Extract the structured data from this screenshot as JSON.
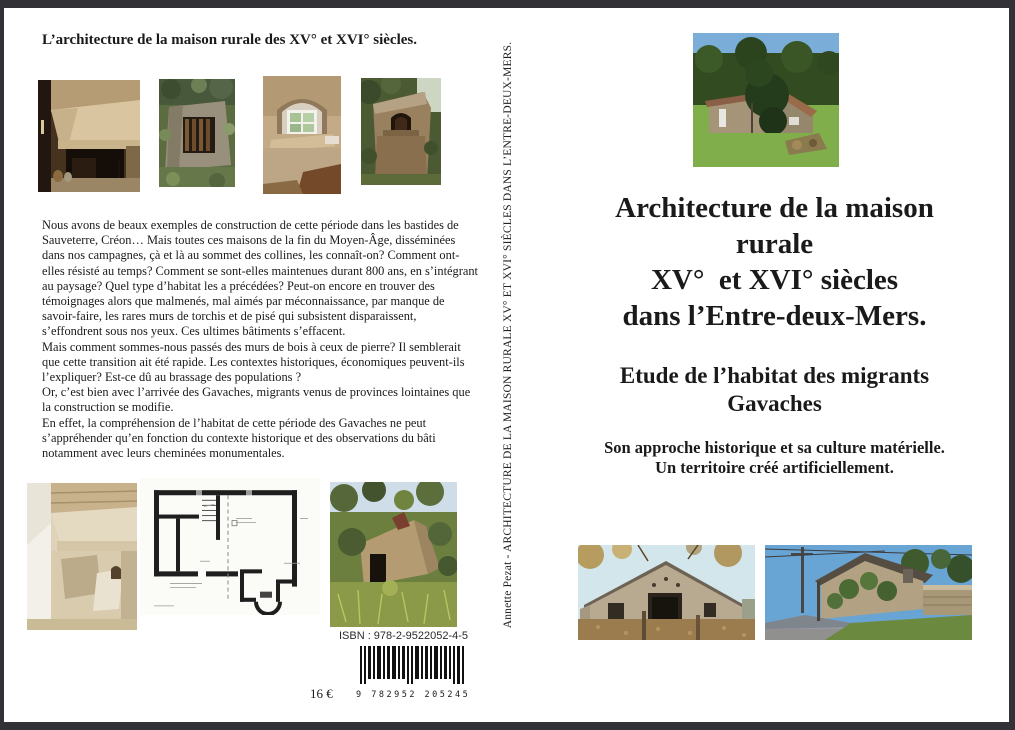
{
  "back_cover": {
    "title": "L’architecture de la maison rurale des XV° et XVI° siècles.",
    "paragraphs": [
      "Nous avons de beaux exemples de construction de cette période dans les bastides de Sauveterre, Créon… Mais toutes ces maisons de la fin du Moyen-Âge, disséminées dans nos campagnes, çà et là au sommet des collines, les connaît-on? Comment ont-elles résisté au temps? Comment se sont-elles maintenues durant 800 ans, en s’intégrant au paysage? Quel type d’habitat les a précédées? Peut-on encore en trouver des témoignages alors que malmenés, mal aimés par méconnaissance, par manque de savoir-faire, les rares murs de torchis et de pisé qui subsistent disparaissent, s’effondrent sous nos yeux. Ces ultimes bâtiments s’effacent.",
      "Mais comment sommes-nous passés des murs de bois à ceux de pierre? Il semblerait que cette transition ait été rapide. Les contextes historiques, économiques peuvent-ils l’expliquer? Est-ce dû au brassage des populations ?",
      "Or, c’est bien avec l’arrivée des Gavaches, migrants venus de provinces lointaines que la construction se modifie.",
      "En effet, la compréhension de l’habitat de cette période des Gavaches ne peut s’appréhender qu’en fonction du contexte historique et des observations du bâti notamment avec leurs cheminées monumentales."
    ],
    "isbn_label": "ISBN : 978-2-9522052-4-5",
    "barcode_digits": "9 782952 205245",
    "price": "16 €",
    "photos": [
      "interior-stone-fireplace",
      "stone-ruin-with-wooden-slats",
      "arched-stone-window",
      "stone-bread-oven",
      "white-stone-fireplace",
      "floor-plan-drawing",
      "overgrown-stone-ruin"
    ]
  },
  "spine": {
    "text": "Annette Pezat - ARCHITECTURE DE LA MAISON RURALE XV° ET XVI° SIÈCLES DANS L’ENTRE-DEUX-MERS."
  },
  "front_cover": {
    "title_lines": [
      "Architecture de la maison",
      "rurale",
      "XV°  et XVI° siècles",
      "dans l’Entre-deux-Mers."
    ],
    "subtitle_lines": [
      "Etude de l’habitat des migrants",
      "Gavaches"
    ],
    "tagline_lines": [
      "Son approche historique et sa culture matérielle.",
      "Un territoire créé artificiellement."
    ],
    "photos": [
      "stone-house-in-meadow",
      "stone-barn-autumn",
      "roadside-stone-house"
    ]
  },
  "colors": {
    "frame": "#313136",
    "paper": "#ffffff",
    "text": "#1a1a1a"
  }
}
